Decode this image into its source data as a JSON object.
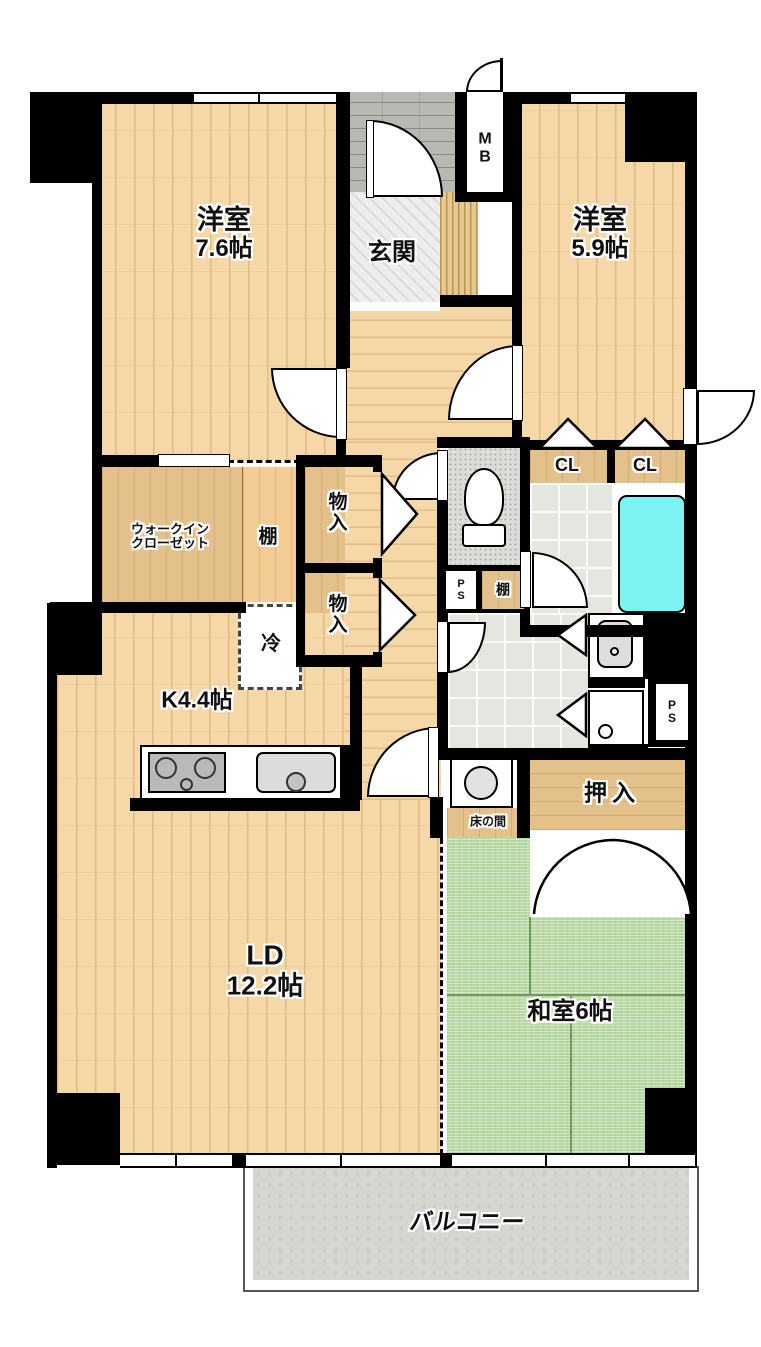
{
  "labels": {
    "room76_name": "洋室",
    "room76_size": "7.6帖",
    "room59_name": "洋室",
    "room59_size": "5.9帖",
    "genkan": "玄関",
    "mb": "MB",
    "wic_line1": "ウォークイン",
    "wic_line2": "クローゼット",
    "wic_shelf": "棚",
    "monoire1": "物入",
    "monoire2": "物入",
    "fridge": "冷",
    "kitchen": "K4.4帖",
    "ps1": "PS",
    "ps2": "PS",
    "wc_shelf": "棚",
    "cl1": "CL",
    "cl2": "CL",
    "oshiire": "押入",
    "tokonoma": "床の間",
    "washitsu": "和室6帖",
    "ld_name": "LD",
    "ld_size": "12.2帖",
    "balcony": "バルコニー"
  },
  "colors": {
    "wall": "#000000",
    "wood_floor": "#f5d7a8",
    "closet_wood": "#e4c08b",
    "tatami_green": "#b9d9a4",
    "bathtub_cyan": "#7df2f2",
    "tile_gray": "#e6e6e1",
    "balcony_gray": "#d6d6d1"
  },
  "fixtures": {
    "toilet": "toilet",
    "bathtub": "bathtub",
    "washbasin": "washbasin",
    "washing_machine_pan": "washing-machine-pan",
    "stove": "kitchen-stove",
    "kitchen_sink": "kitchen-sink",
    "water_heater": "water-heater-circle"
  }
}
